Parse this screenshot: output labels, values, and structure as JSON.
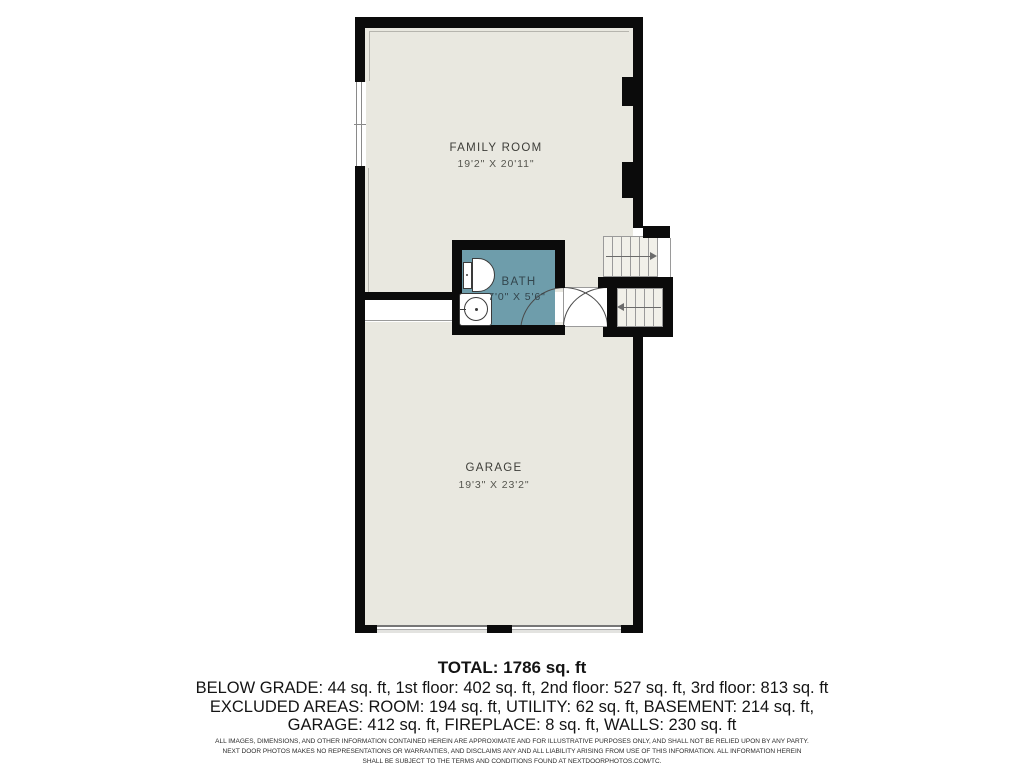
{
  "plan": {
    "rooms": {
      "family_room": {
        "name": "FAMILY ROOM",
        "dims": "19'2\" X 20'11\""
      },
      "bath": {
        "name": "BATH",
        "dims": "7'0\" X 5'6\""
      },
      "garage": {
        "name": "GARAGE",
        "dims": "19'3\" X 23'2\""
      }
    },
    "icons": [
      "toilet-icon",
      "sink-icon",
      "door-swing-arc",
      "stairs-up-arrow",
      "stairs-down-arrow",
      "window"
    ]
  },
  "summary": {
    "total": "TOTAL: 1786 sq. ft",
    "floors_line": "BELOW GRADE: 44 sq. ft, 1st floor: 402 sq. ft, 2nd floor: 527 sq. ft, 3rd floor: 813 sq. ft",
    "excluded_line_1": "EXCLUDED AREAS: ROOM: 194 sq. ft, UTILITY: 62 sq. ft, BASEMENT: 214 sq. ft,",
    "excluded_line_2": "GARAGE: 412 sq. ft, FIREPLACE: 8 sq. ft, WALLS: 230 sq. ft"
  },
  "disclaimer": {
    "line1": "ALL IMAGES, DIMENSIONS, AND OTHER INFORMATION CONTAINED HEREIN ARE APPROXIMATE AND FOR ILLUSTRATIVE PURPOSES ONLY, AND SHALL NOT BE RELIED UPON BY ANY PARTY.",
    "line2": "NEXT DOOR PHOTOS MAKES NO REPRESENTATIONS OR WARRANTIES, AND DISCLAIMS ANY AND ALL LIABILITY ARISING FROM USE OF THIS INFORMATION. ALL INFORMATION HEREIN",
    "line3": "SHALL BE SUBJECT TO THE TERMS AND CONDITIONS FOUND AT NEXTDOORPHOTOS.COM/TC."
  },
  "colors": {
    "wall": "#0b0b0b",
    "room_fill": "#e9e8e0",
    "bath_fill": "#6e9dab",
    "stair_fill": "#f1f0e9",
    "page_background": "#ffffff"
  }
}
